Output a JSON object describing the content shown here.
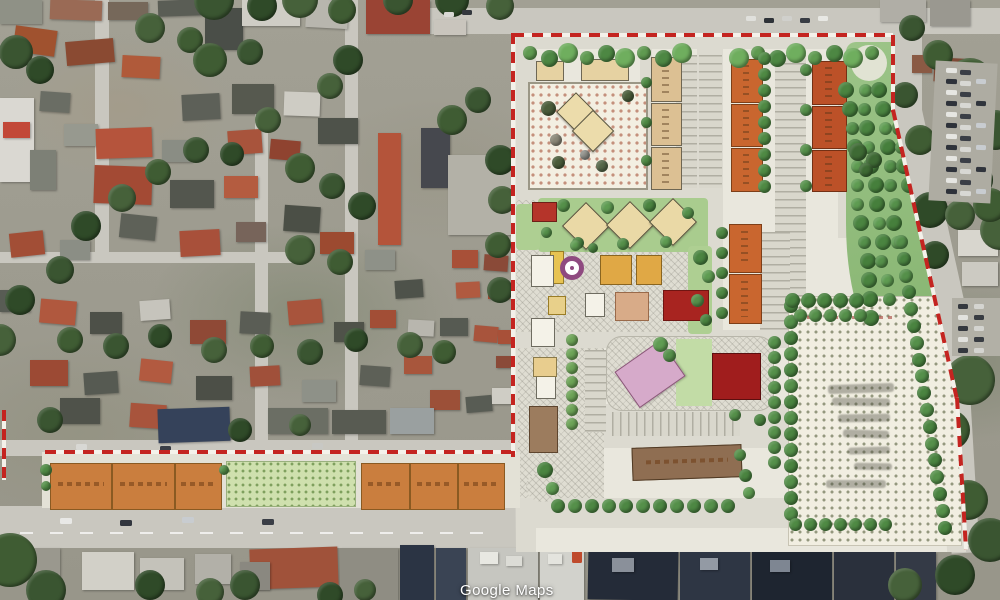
{
  "watermark": {
    "text": "Google Maps"
  },
  "map": {
    "view_type": "satellite",
    "overlay": "development-site-plan"
  },
  "palette": {
    "boundary_dash": "#c42420",
    "plan_paper": "#e9e7dd",
    "plan_road": "#dcdad0",
    "orange_block": "#ca7e3e",
    "deep_orange_block": "#bc5128",
    "tan_block": "#dcc093",
    "red_building": "#a82420",
    "pink_building": "#d6aaca",
    "yellow_building": "#e0a845",
    "purple_feature": "#8f4a80",
    "park_green": "#55904a",
    "satellite_road": "#c9c7bf",
    "watermark_color": "#ffffff"
  }
}
